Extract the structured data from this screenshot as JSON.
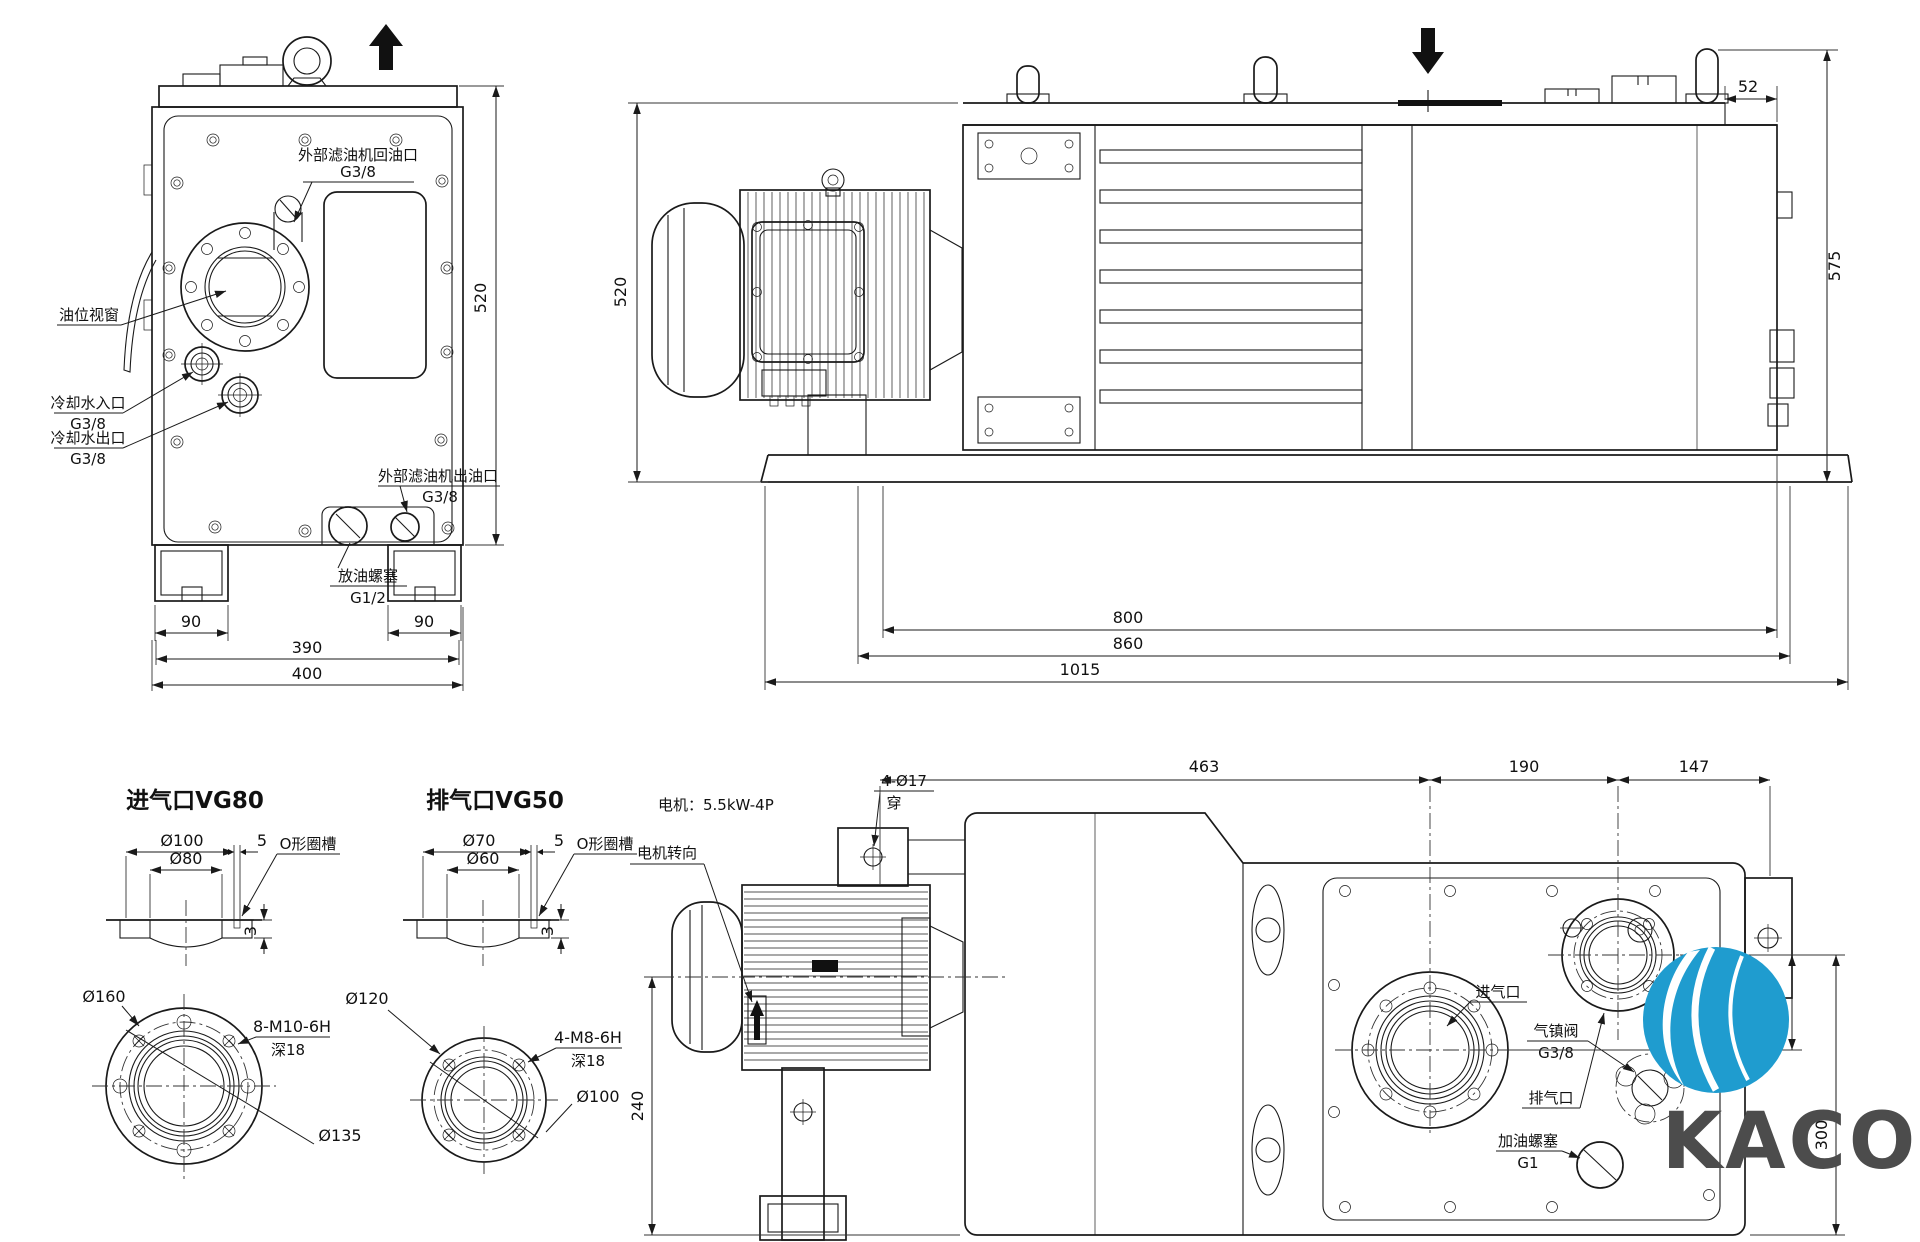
{
  "brand": {
    "name": "KACO"
  },
  "front_view": {
    "labels": {
      "return_port_line1": "外部滤油机回油口",
      "return_port_line2": "G3/8",
      "oil_sight": "油位视窗",
      "cooling_in_line1": "冷却水入口",
      "cooling_in_line2": "G3/8",
      "cooling_out_line1": "冷却水出口",
      "cooling_out_line2": "G3/8",
      "filter_out_line1": "外部滤油机出油口",
      "filter_out_line2": "G3/8",
      "drain_line1": "放油螺塞",
      "drain_line2": "G1/2"
    },
    "dims": {
      "height": "520",
      "foot_left": "90",
      "foot_right": "90",
      "body_width": "390",
      "overall_width": "400"
    }
  },
  "side_view": {
    "dims": {
      "top_inset": "52",
      "overall_height": "575",
      "body_height": "520",
      "mount_length": "800",
      "base_length": "860",
      "overall_length": "1015"
    }
  },
  "inlet_section": {
    "title": "进气口VG80",
    "dims": {
      "outer_dia": "Ø100",
      "bore_dia": "Ø80",
      "groove_offset": "5",
      "groove_label": "O形圈槽",
      "groove_depth": "3",
      "flange_dia": "Ø160",
      "bolt_spec": "8-M10-6H",
      "bolt_depth": "深18",
      "pcd": "Ø135"
    }
  },
  "exhaust_section": {
    "title": "排气口VG50",
    "dims": {
      "outer_dia": "Ø70",
      "bore_dia": "Ø60",
      "groove_offset": "5",
      "groove_label": "O形圈槽",
      "groove_depth": "3",
      "flange_dia": "Ø120",
      "bolt_spec": "4-M8-6H",
      "bolt_depth": "深18",
      "pcd": "Ø100"
    }
  },
  "top_view": {
    "labels": {
      "motor": "电机：5.5kW-4P",
      "motor_rotation": "电机转向",
      "mount_holes_line1": "4-Ø17",
      "mount_holes_line2": "穿",
      "inlet": "进气口",
      "exhaust": "排气口",
      "ballast_line1": "气镇阀",
      "ballast_line2": "G3/8",
      "oil_fill_line1": "加油螺塞",
      "oil_fill_line2": "G1"
    },
    "dims": {
      "motor_to_inlet": "463",
      "inlet_to_exhaust": "190",
      "exhaust_to_edge": "147",
      "port_offset": "100",
      "inlet_to_front": "300",
      "axis_to_front": "240"
    }
  }
}
